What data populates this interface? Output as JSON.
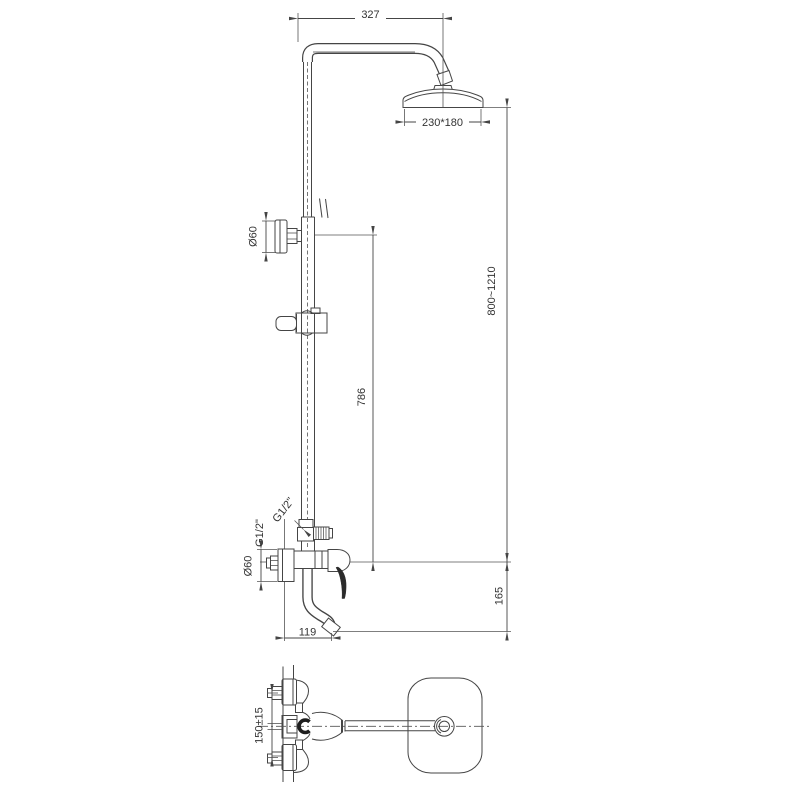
{
  "front_view": {
    "dim_arm_width": "327",
    "dim_head_size": "230*180",
    "dim_overall_height": "800~1210",
    "dim_riser_length": "786",
    "dim_spout_drop": "165",
    "dim_spout_reach": "119",
    "dim_bracket_diameter": "Ø60",
    "dim_escutcheon_diameter": "Ø60",
    "label_diverter_thread": "G1/2\"",
    "label_inlet_thread": "G1/2\""
  },
  "top_view": {
    "dim_inlet_spacing": "150±15"
  },
  "colors": {
    "line": "#454545",
    "text": "#333333",
    "background": "#ffffff",
    "handle": "#2b2b2b"
  }
}
